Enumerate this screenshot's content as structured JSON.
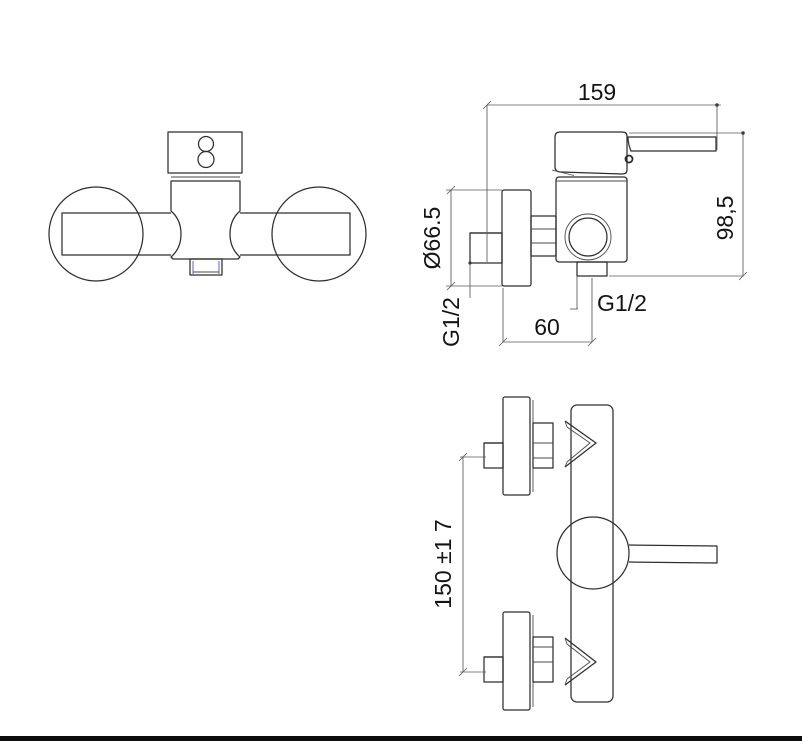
{
  "colors": {
    "background": "#ffffff",
    "line": "#2e2e2e",
    "dimension_line": "#5a5a5a",
    "text": "#141414",
    "accent_blue": "#6b6bd6",
    "footer_rule": "#0d0d0d"
  },
  "side_view": {
    "dim_width": "159",
    "dim_height": "98,5",
    "dim_flange_diameter": "Ø66.5",
    "label_inlet_thread": "G1/2",
    "label_outlet_thread": "G1/2",
    "dim_wall_to_outlet": "60"
  },
  "front_view": {
    "dim_connection_spacing": "150 ±1 7"
  }
}
